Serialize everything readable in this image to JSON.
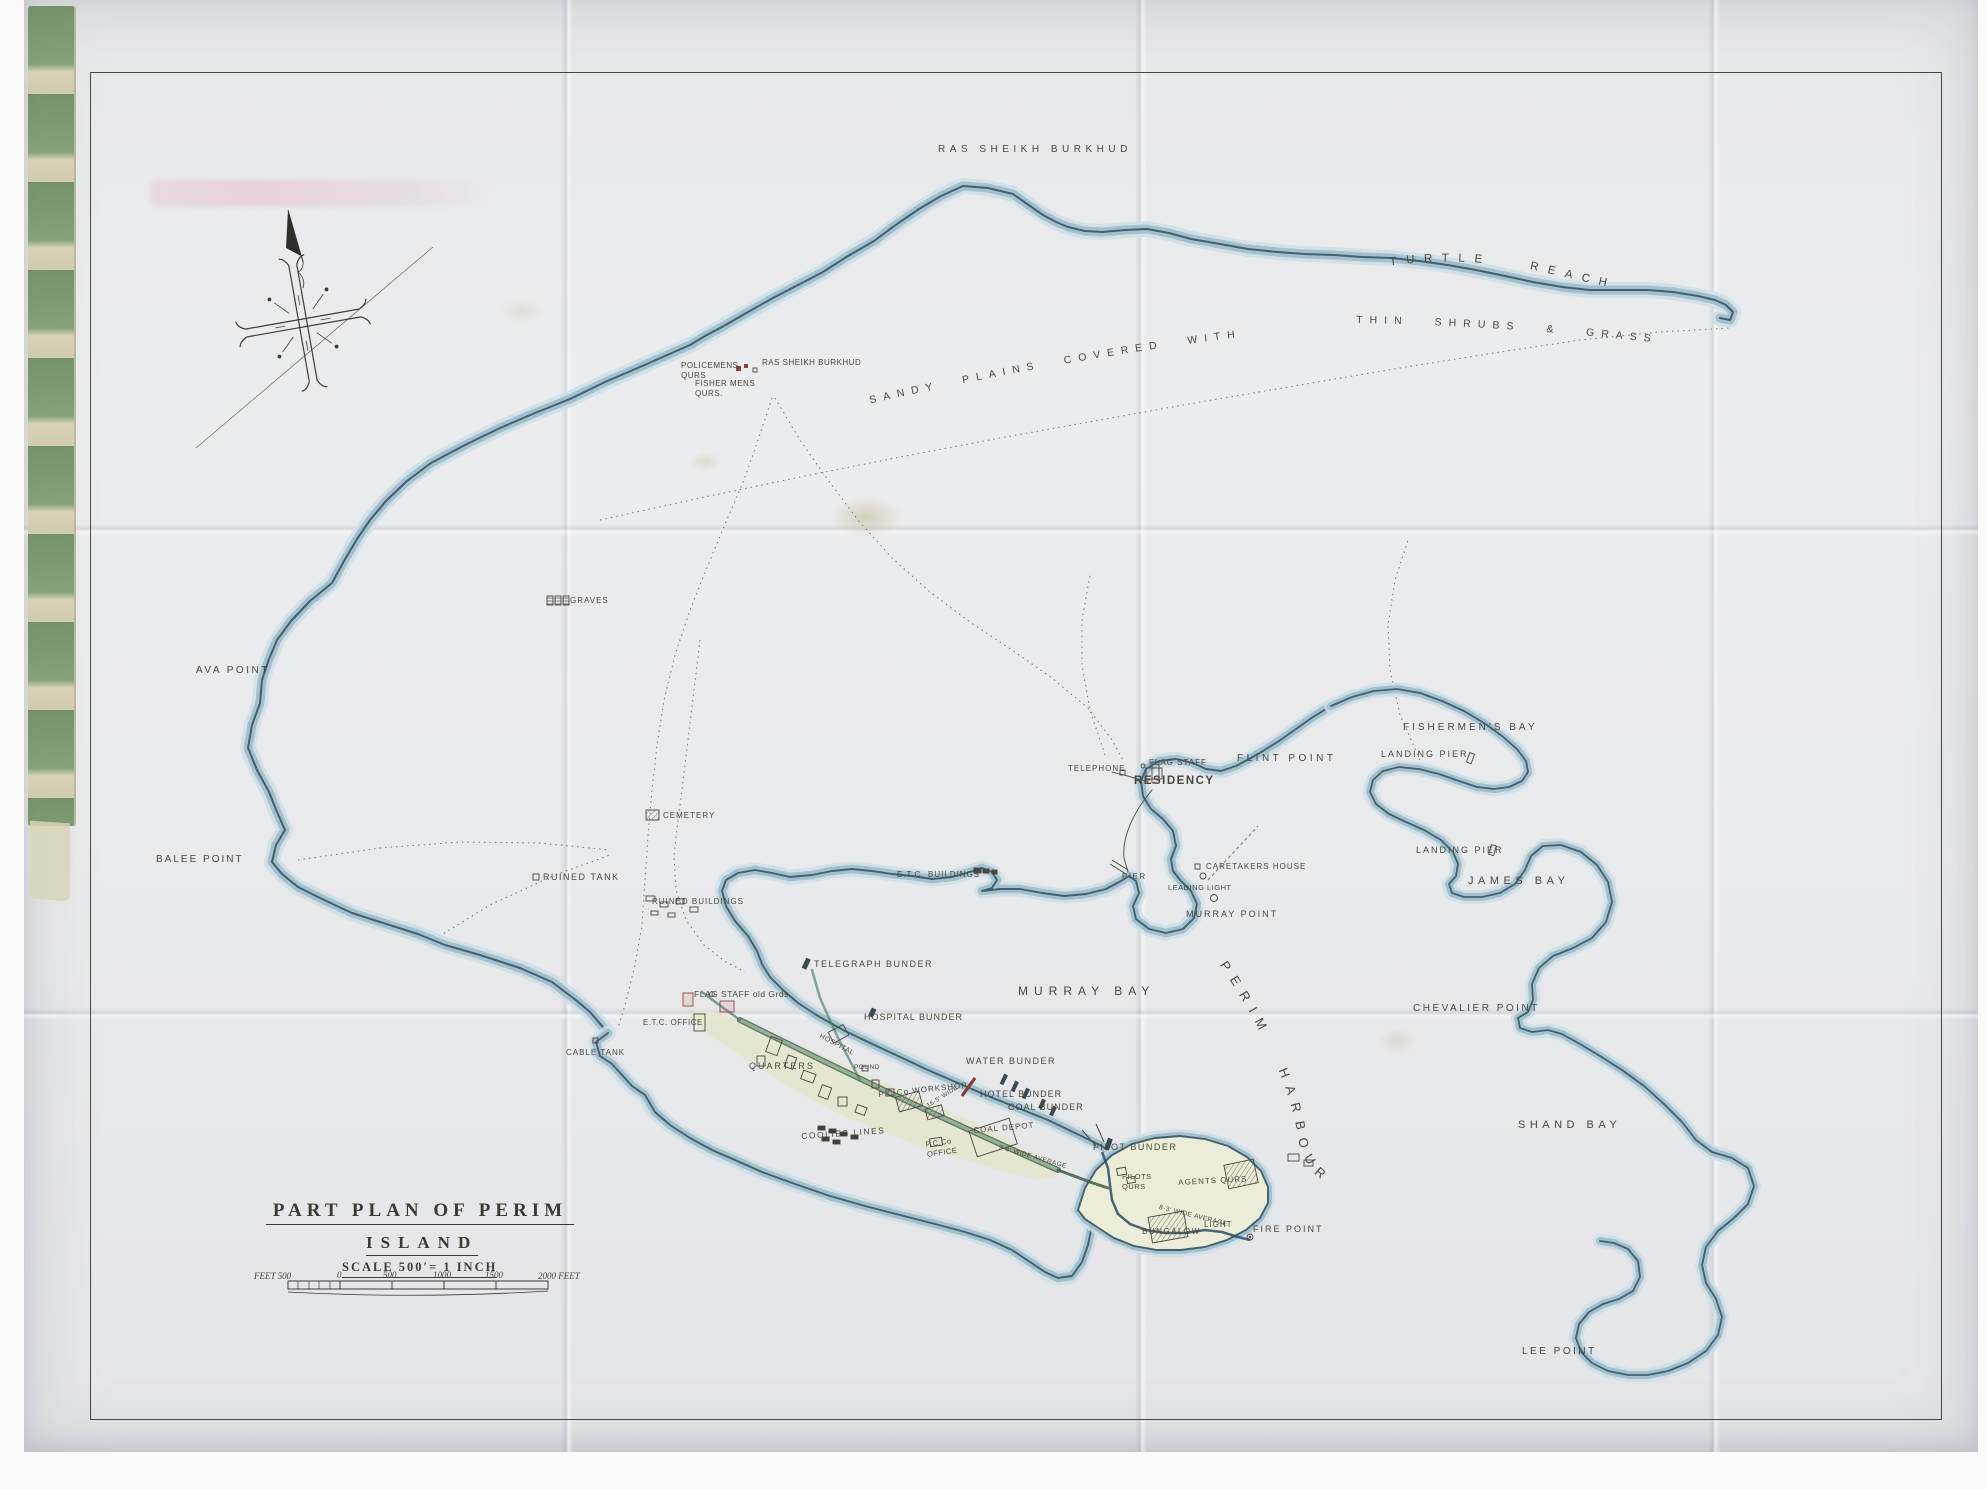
{
  "map": {
    "title_line1": "PART PLAN OF PERIM",
    "title_line2": "ISLAND",
    "scale_text": "SCALE 500′= 1 INCH"
  },
  "scale_bar": {
    "feet_left": "FEET 500",
    "t0": "0",
    "t500": "500",
    "t1000": "1000",
    "t1500": "1500",
    "t2000": "2000 FEET"
  },
  "curved": {
    "turtle": "TURTLE REACH",
    "sandy": "SANDY PLAINS COVERED WITH",
    "shrubs": "THIN SHRUBS & GRASS",
    "harbour": "PERIM HARBOUR"
  },
  "labels": [
    {
      "id": "ras-sheikh-burkhud-beach",
      "text": "RAS SHEIKH BURKHUD",
      "x": 938,
      "y": 143,
      "fs": 10,
      "ls": 4.5
    },
    {
      "id": "policemens-qurs",
      "text": "POLICEMENS\nQURS",
      "x": 681,
      "y": 361,
      "fs": 8,
      "ls": 0.5
    },
    {
      "id": "ras-sheikh-burkhud-village",
      "text": "RAS SHEIKH BURKHUD",
      "x": 762,
      "y": 358,
      "fs": 8,
      "ls": 0.5
    },
    {
      "id": "fisher-mens-qurs",
      "text": "FISHER MENS\nQURS.",
      "x": 695,
      "y": 379,
      "fs": 8,
      "ls": 0.5
    },
    {
      "id": "graves",
      "text": "GRAVES",
      "x": 570,
      "y": 596,
      "fs": 8,
      "ls": 1
    },
    {
      "id": "ava-point",
      "text": "AVA POINT",
      "x": 196,
      "y": 664,
      "fs": 10,
      "ls": 2.5
    },
    {
      "id": "balee-point",
      "text": "BALEE POINT",
      "x": 156,
      "y": 853,
      "fs": 10,
      "ls": 2
    },
    {
      "id": "ruined-tank",
      "text": "RUINED TANK",
      "x": 543,
      "y": 872,
      "fs": 9,
      "ls": 1.5
    },
    {
      "id": "ruined-buildings",
      "text": "RUINED BUILDINGS",
      "x": 652,
      "y": 897,
      "fs": 8,
      "ls": 1
    },
    {
      "id": "cemetery",
      "text": "CEMETERY",
      "x": 663,
      "y": 811,
      "fs": 8,
      "ls": 1
    },
    {
      "id": "cable-tank",
      "text": "CABLE TANK",
      "x": 566,
      "y": 1048,
      "fs": 8,
      "ls": 1
    },
    {
      "id": "etc-buildings",
      "text": "E.T.C. BUILDINGS",
      "x": 897,
      "y": 870,
      "fs": 8,
      "ls": 1
    },
    {
      "id": "telephone",
      "text": "TELEPHONE",
      "x": 1068,
      "y": 764,
      "fs": 8,
      "ls": 1
    },
    {
      "id": "flag-staff-residency",
      "text": "FLAG STAFF",
      "x": 1149,
      "y": 758,
      "fs": 8,
      "ls": 1
    },
    {
      "id": "residency",
      "text": "RESIDENCY",
      "x": 1134,
      "y": 774,
      "fs": 11.5,
      "ls": 1.5,
      "w": 600
    },
    {
      "id": "flint-point",
      "text": "FLINT POINT",
      "x": 1237,
      "y": 752,
      "fs": 10,
      "ls": 3.5
    },
    {
      "id": "fishermens-bay",
      "text": "FISHERMEN'S BAY",
      "x": 1403,
      "y": 721,
      "fs": 10,
      "ls": 3
    },
    {
      "id": "landing-pier-1",
      "text": "LANDING PIER",
      "x": 1381,
      "y": 749,
      "fs": 9,
      "ls": 2
    },
    {
      "id": "landing-pier-2",
      "text": "LANDING PIER",
      "x": 1416,
      "y": 845,
      "fs": 9,
      "ls": 2
    },
    {
      "id": "james-bay",
      "text": "JAMES BAY",
      "x": 1468,
      "y": 874,
      "fs": 11,
      "ls": 4.5
    },
    {
      "id": "chevalier-point",
      "text": "CHEVALIER POINT",
      "x": 1413,
      "y": 1002,
      "fs": 10,
      "ls": 2.5
    },
    {
      "id": "shand-bay",
      "text": "SHAND BAY",
      "x": 1518,
      "y": 1118,
      "fs": 11,
      "ls": 4.5
    },
    {
      "id": "lee-point",
      "text": "LEE POINT",
      "x": 1522,
      "y": 1345,
      "fs": 10,
      "ls": 2.5
    },
    {
      "id": "murray-bay",
      "text": "MURRAY BAY",
      "x": 1018,
      "y": 984,
      "fs": 12,
      "ls": 6
    },
    {
      "id": "murray-point",
      "text": "MURRAY POINT",
      "x": 1186,
      "y": 909,
      "fs": 9,
      "ls": 2
    },
    {
      "id": "pier",
      "text": "PIER",
      "x": 1122,
      "y": 872,
      "fs": 8,
      "ls": 1.5
    },
    {
      "id": "caretakers-house",
      "text": "CARETAKERS HOUSE",
      "x": 1206,
      "y": 862,
      "fs": 8,
      "ls": 1
    },
    {
      "id": "leading-light",
      "text": "LEADING LIGHT",
      "x": 1168,
      "y": 883,
      "fs": 7.5,
      "ls": 0.5
    },
    {
      "id": "telegraph-bunder",
      "text": "TELEGRAPH BUNDER",
      "x": 814,
      "y": 959,
      "fs": 9,
      "ls": 1.5
    },
    {
      "id": "flag-staff-old",
      "text": "FLAG STAFF old Grds",
      "x": 694,
      "y": 989,
      "fs": 8.5,
      "ls": 0.5
    },
    {
      "id": "etc-office",
      "text": "E.T.C. OFFICE",
      "x": 643,
      "y": 1018,
      "fs": 8,
      "ls": 0.5
    },
    {
      "id": "hospital-bunder",
      "text": "HOSPITAL BUNDER",
      "x": 864,
      "y": 1012,
      "fs": 9,
      "ls": 1
    },
    {
      "id": "hospital",
      "text": "HOSPITAL",
      "x": 822,
      "y": 1032,
      "fs": 7,
      "ls": 0.5,
      "rot": 28
    },
    {
      "id": "quarters",
      "text": "QUARTERS",
      "x": 749,
      "y": 1061,
      "fs": 9,
      "ls": 2
    },
    {
      "id": "pound",
      "text": "POUND",
      "x": 854,
      "y": 1064,
      "fs": 6.5,
      "ls": 0.5
    },
    {
      "id": "pcco-workshop",
      "text": "P.C.Co WORKSHOP",
      "x": 878,
      "y": 1090,
      "fs": 8,
      "ls": 1,
      "rot": -6
    },
    {
      "id": "coolies-lines",
      "text": "COOLIES LINES",
      "x": 801,
      "y": 1131,
      "fs": 8.5,
      "ls": 1.5,
      "rot": -4
    },
    {
      "id": "pcco-office",
      "text": "P.C.Co\nOFFICE",
      "x": 925,
      "y": 1140,
      "fs": 7.5,
      "ls": 0.5,
      "rot": -8
    },
    {
      "id": "water-bunder",
      "text": "WATER BUNDER",
      "x": 966,
      "y": 1056,
      "fs": 9,
      "ls": 1.5
    },
    {
      "id": "hotel-bunder",
      "text": "HOTEL BUNDER",
      "x": 980,
      "y": 1089,
      "fs": 9,
      "ls": 1
    },
    {
      "id": "coal-bunder",
      "text": "COAL BUNDER",
      "x": 1008,
      "y": 1102,
      "fs": 9,
      "ls": 1
    },
    {
      "id": "coal-depot",
      "text": "COAL DEPOT",
      "x": 973,
      "y": 1126,
      "fs": 8,
      "ls": 1,
      "rot": -5
    },
    {
      "id": "pilot-bunder",
      "text": "PILOT BUNDER",
      "x": 1093,
      "y": 1142,
      "fs": 9,
      "ls": 1.5
    },
    {
      "id": "pilots-qurs",
      "text": "PILOTS\nQURS",
      "x": 1122,
      "y": 1172,
      "fs": 7.5,
      "ls": 0.5
    },
    {
      "id": "agents-qurs",
      "text": "AGENTS QURS",
      "x": 1178,
      "y": 1178,
      "fs": 8,
      "ls": 1,
      "rot": -3
    },
    {
      "id": "wide-8-3",
      "text": "8·3′ WIDE AVERAGE",
      "x": 1160,
      "y": 1204,
      "fs": 6.5,
      "ls": 0.5,
      "rot": 14
    },
    {
      "id": "light",
      "text": "LIGHT",
      "x": 1204,
      "y": 1220,
      "fs": 8,
      "ls": 1
    },
    {
      "id": "bungalow",
      "text": "BUNGALOW",
      "x": 1142,
      "y": 1227,
      "fs": 8,
      "ls": 1.5
    },
    {
      "id": "fire-point",
      "text": "FIRE POINT",
      "x": 1253,
      "y": 1224,
      "fs": 9,
      "ls": 2
    },
    {
      "id": "wide-16-5",
      "text": "16·5′ WIDE",
      "x": 926,
      "y": 1104,
      "fs": 6,
      "ls": 0.5,
      "rot": -32
    },
    {
      "id": "wide-9-8",
      "text": "9·8′ WIDE AVERAGE",
      "x": 1000,
      "y": 1144,
      "fs": 6.5,
      "ls": 0.5,
      "rot": 16
    }
  ],
  "colors": {
    "paper": "#e9eaec",
    "ink": "#4b473f",
    "title_ink": "#3c3a33",
    "water_dark": "#44606e",
    "water_mid": "#9cbccb",
    "water_light": "#cfdfe6",
    "settlement_wash": "#e3e5c8",
    "road_green": "#3d5c4e",
    "channel_blue": "#2e4a66",
    "red_building": "#a04038",
    "binding_green": "#6b8d60",
    "binding_cream": "#d8d2b4"
  }
}
